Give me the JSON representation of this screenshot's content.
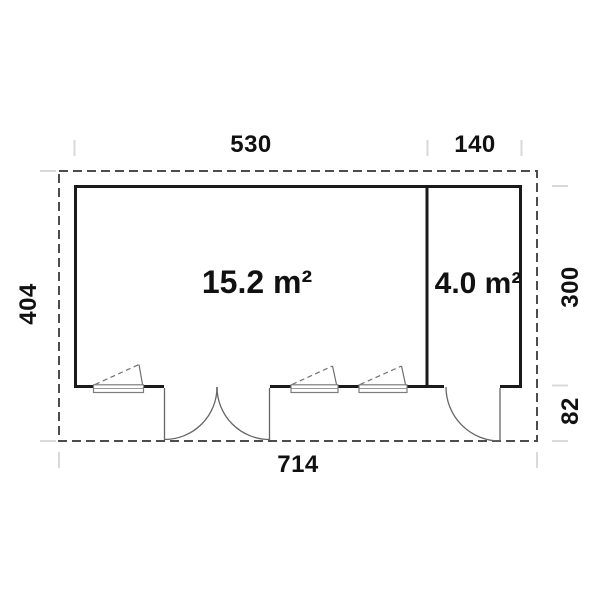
{
  "plan": {
    "room_main": {
      "area_label": "15.2 m²"
    },
    "room_side": {
      "area_label": "4.0 m²"
    },
    "dimensions": {
      "width_main": "530",
      "width_side": "140",
      "depth_total": "404",
      "depth_side": "300",
      "porch_depth": "82",
      "width_total": "714"
    },
    "colors": {
      "wall": "#1a1a1a",
      "roof_outline": "#4d4d4d",
      "thin_line": "#666666",
      "tick": "#d9d9d9",
      "text": "#111111",
      "background": "#ffffff"
    }
  }
}
